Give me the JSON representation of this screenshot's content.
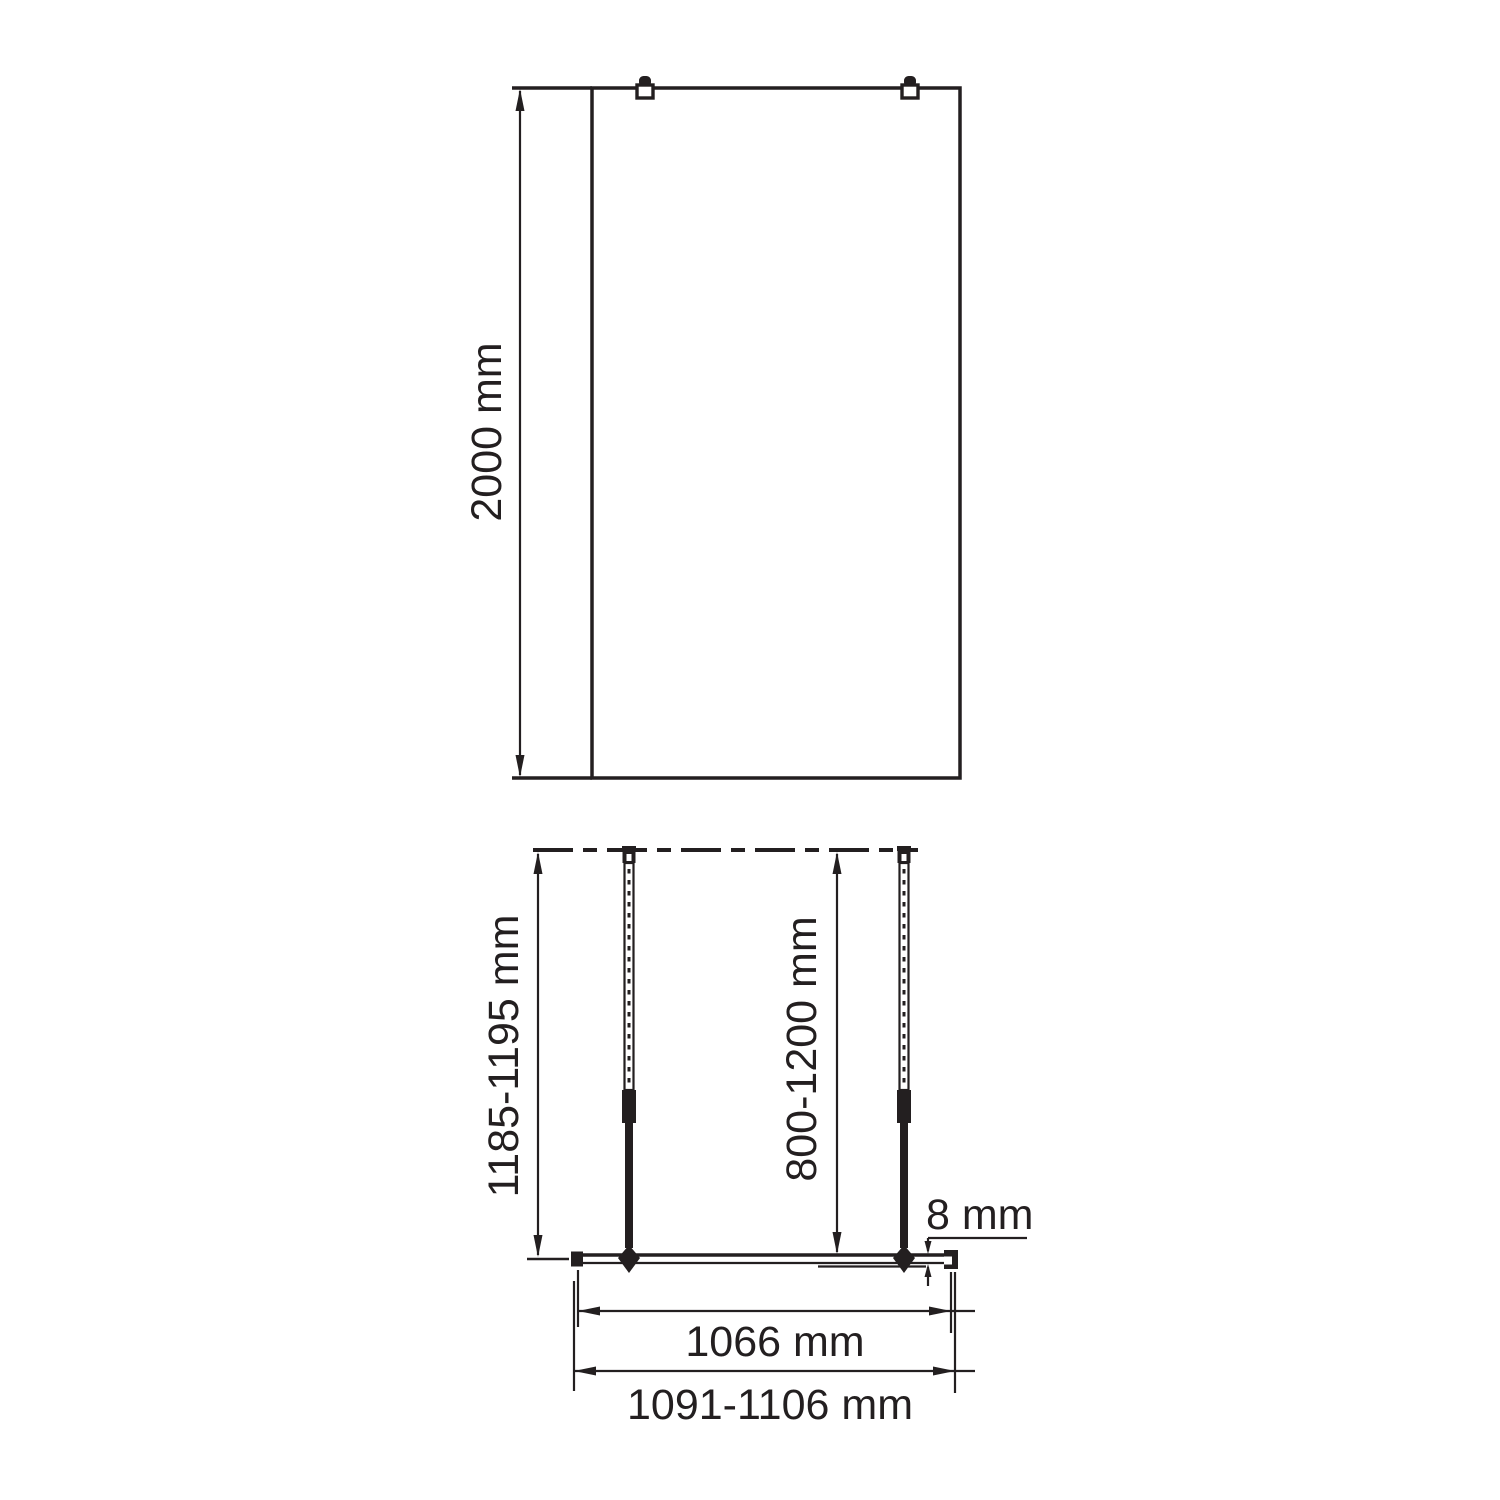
{
  "drawing": {
    "title": "shower-walk-in-panel-dimension-drawing",
    "front_view": {
      "height_label": "2000 mm"
    },
    "plan_view": {
      "bar_length_label": "1185-1195 mm",
      "wall_distance_label": "800-1200 mm",
      "glass_thickness_label": "8 mm",
      "glass_width_label": "1066 mm",
      "overall_width_label": "1091-1106 mm"
    },
    "colors": {
      "line": "#231f20",
      "background": "#ffffff"
    }
  }
}
